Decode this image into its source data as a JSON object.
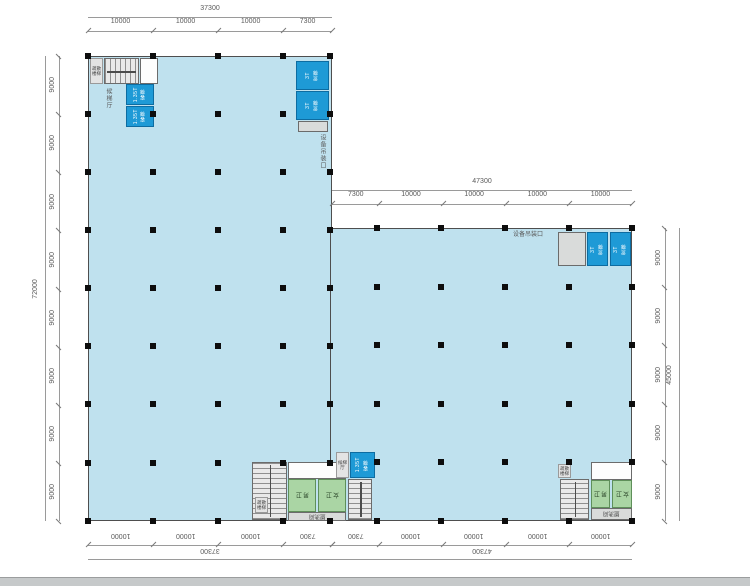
{
  "drawing": {
    "title": "factory-floor-plan",
    "dimensions": {
      "top_left": {
        "total": "37300",
        "segments": [
          10000,
          10000,
          10000,
          7300
        ]
      },
      "top_right": {
        "total": "47300",
        "segments": [
          7300,
          10000,
          10000,
          10000,
          10000
        ]
      },
      "left_side": {
        "total": "72000",
        "segments": [
          9000,
          9000,
          9000,
          9000,
          9000,
          9000,
          9000,
          9000
        ]
      },
      "right_side": {
        "total": "45000",
        "segments": [
          9000,
          9000,
          9000,
          9000,
          9000
        ]
      },
      "bottom_left": {
        "total": "37300",
        "segments": [
          10000,
          10000,
          10000,
          7300
        ]
      },
      "bottom_right": {
        "total": "47300",
        "segments": [
          7300,
          10000,
          10000,
          10000,
          10000
        ]
      }
    },
    "labels": {
      "passenger_lift_name": "客梯",
      "passenger_lift_capacity": "1.35T",
      "freight_lift_name": "货梯",
      "freight_lift_capacity": "3T",
      "stair": "疏散楼梯",
      "lift_lobby": "候梯厅",
      "equipment_hoist_opening": "设备吊装口",
      "toilet_male": "男卫",
      "toilet_female": "女卫",
      "washroom": "盥洗间"
    },
    "colors": {
      "floor": "#bfe1ee",
      "wall": "#4e4e4e",
      "lift": "#1e9ad6",
      "toilet": "#aad5a4",
      "grayblock": "#d9dbda",
      "dimline": "#9a9a9a",
      "dimtick": "#7a7a7a",
      "dimtext": "#5a5a5a",
      "footer": "#c6c9ca"
    }
  }
}
